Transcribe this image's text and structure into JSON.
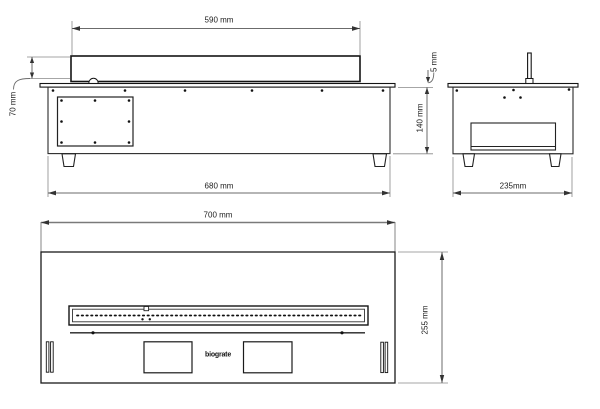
{
  "dimensions": {
    "front_top": "590 mm",
    "front_left": "70 mm",
    "front_bottom": "680 mm",
    "side_lip": "5 mm",
    "side_height": "140 mm",
    "side_bottom": "235mm",
    "top_width": "700 mm",
    "top_depth": "255 mm"
  },
  "logo": "biograte",
  "colors": {
    "object_line": "#1a1a1a",
    "dimension_line": "#6b6b6b",
    "extension_line": "#888888",
    "text": "#1c1c1c",
    "background": "#ffffff"
  }
}
